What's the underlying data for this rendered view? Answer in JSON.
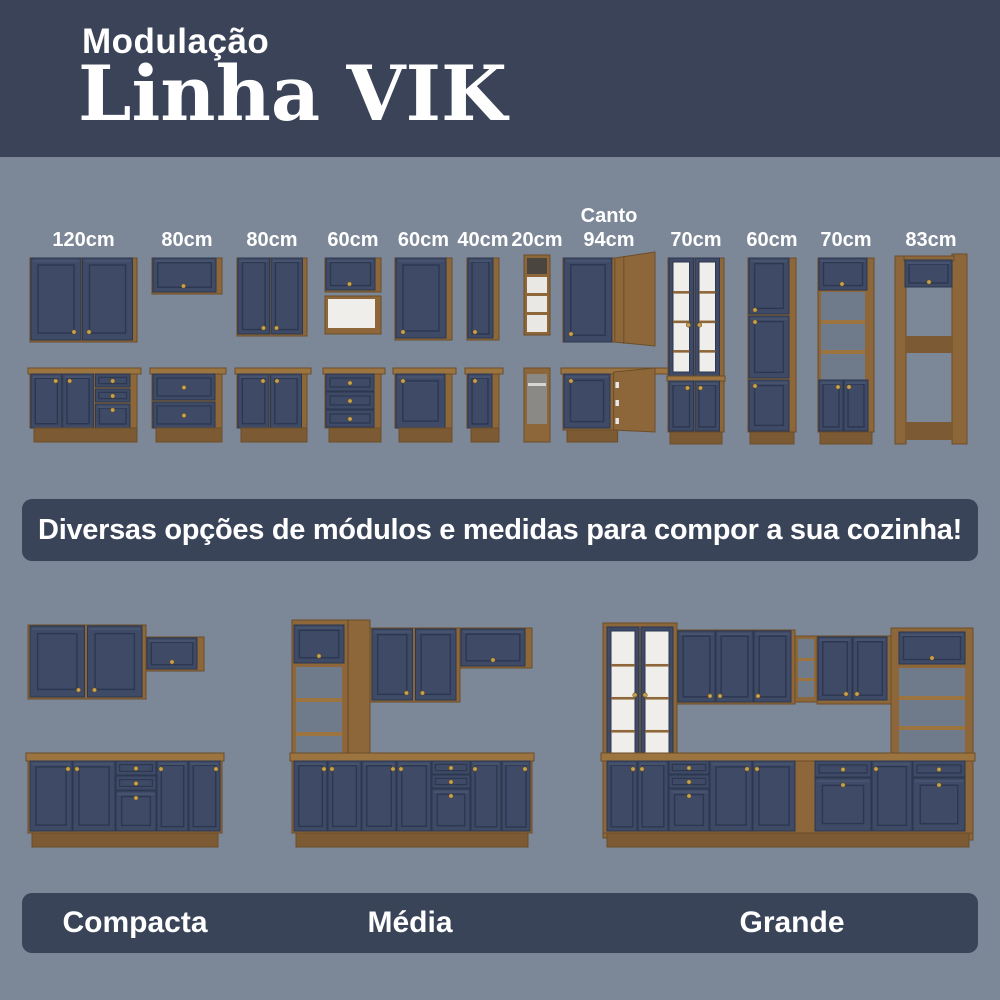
{
  "header": {
    "kicker": "Modulação",
    "title": "Linha VIK"
  },
  "banner": {
    "text": "Diversas opções de módulos e medidas para compor a sua cozinha!"
  },
  "modules": [
    {
      "label": "120cm",
      "label_lines": [
        "120cm"
      ],
      "wall": "wall-2door-wide",
      "base": "base-2door-drawerstack"
    },
    {
      "label": "80cm",
      "label_lines": [
        "80cm"
      ],
      "wall": "wall-flip",
      "base": "base-2drawer"
    },
    {
      "label": "80cm",
      "label_lines": [
        "80cm"
      ],
      "wall": "wall-2door",
      "base": "base-2door"
    },
    {
      "label": "60cm",
      "label_lines": [
        "60cm"
      ],
      "wall": "wall-flip-open",
      "base": "base-3drawer"
    },
    {
      "label": "60cm",
      "label_lines": [
        "60cm"
      ],
      "wall": "wall-1door",
      "base": "base-1door"
    },
    {
      "label": "40cm",
      "label_lines": [
        "40cm"
      ],
      "wall": "wall-1door",
      "base": "base-1door"
    },
    {
      "label": "20cm",
      "label_lines": [
        "20cm"
      ],
      "wall": "wall-open-shelf",
      "base": "base-open-rail"
    },
    {
      "label": "Canto 94cm",
      "label_lines": [
        "Canto",
        "94cm"
      ],
      "wall": "wall-corner",
      "base": "base-corner"
    },
    {
      "label": "70cm",
      "label_lines": [
        "70cm"
      ],
      "tall": "tall-glass"
    },
    {
      "label": "60cm",
      "label_lines": [
        "60cm"
      ],
      "tall": "tall-3door"
    },
    {
      "label": "70cm",
      "label_lines": [
        "70cm"
      ],
      "tall": "tall-open-middle"
    },
    {
      "label": "83cm",
      "label_lines": [
        "83cm"
      ],
      "tall": "tall-open-frame"
    }
  ],
  "kitchens": [
    {
      "label": "Compacta"
    },
    {
      "label": "Média"
    },
    {
      "label": "Grande"
    }
  ],
  "colors": {
    "page_bg": "#7c8797",
    "header_bg": "#3a4357",
    "banner_bg": "#3a4459",
    "cabinet_navy": "#3e4a66",
    "cabinet_navy_dark": "#2c3750",
    "cabinet_navy_light": "#46536f",
    "wood": "#8d6739",
    "wood_dark": "#6b4d2a",
    "wood_light": "#9c7440",
    "wood_deep": "#7c5a33",
    "knob_gold": "#c9a24e",
    "interior_white": "#efeeea",
    "interior_gray": "#8a8985",
    "open_shadow": "#6f7a8a",
    "label_text": "#ffffff"
  }
}
